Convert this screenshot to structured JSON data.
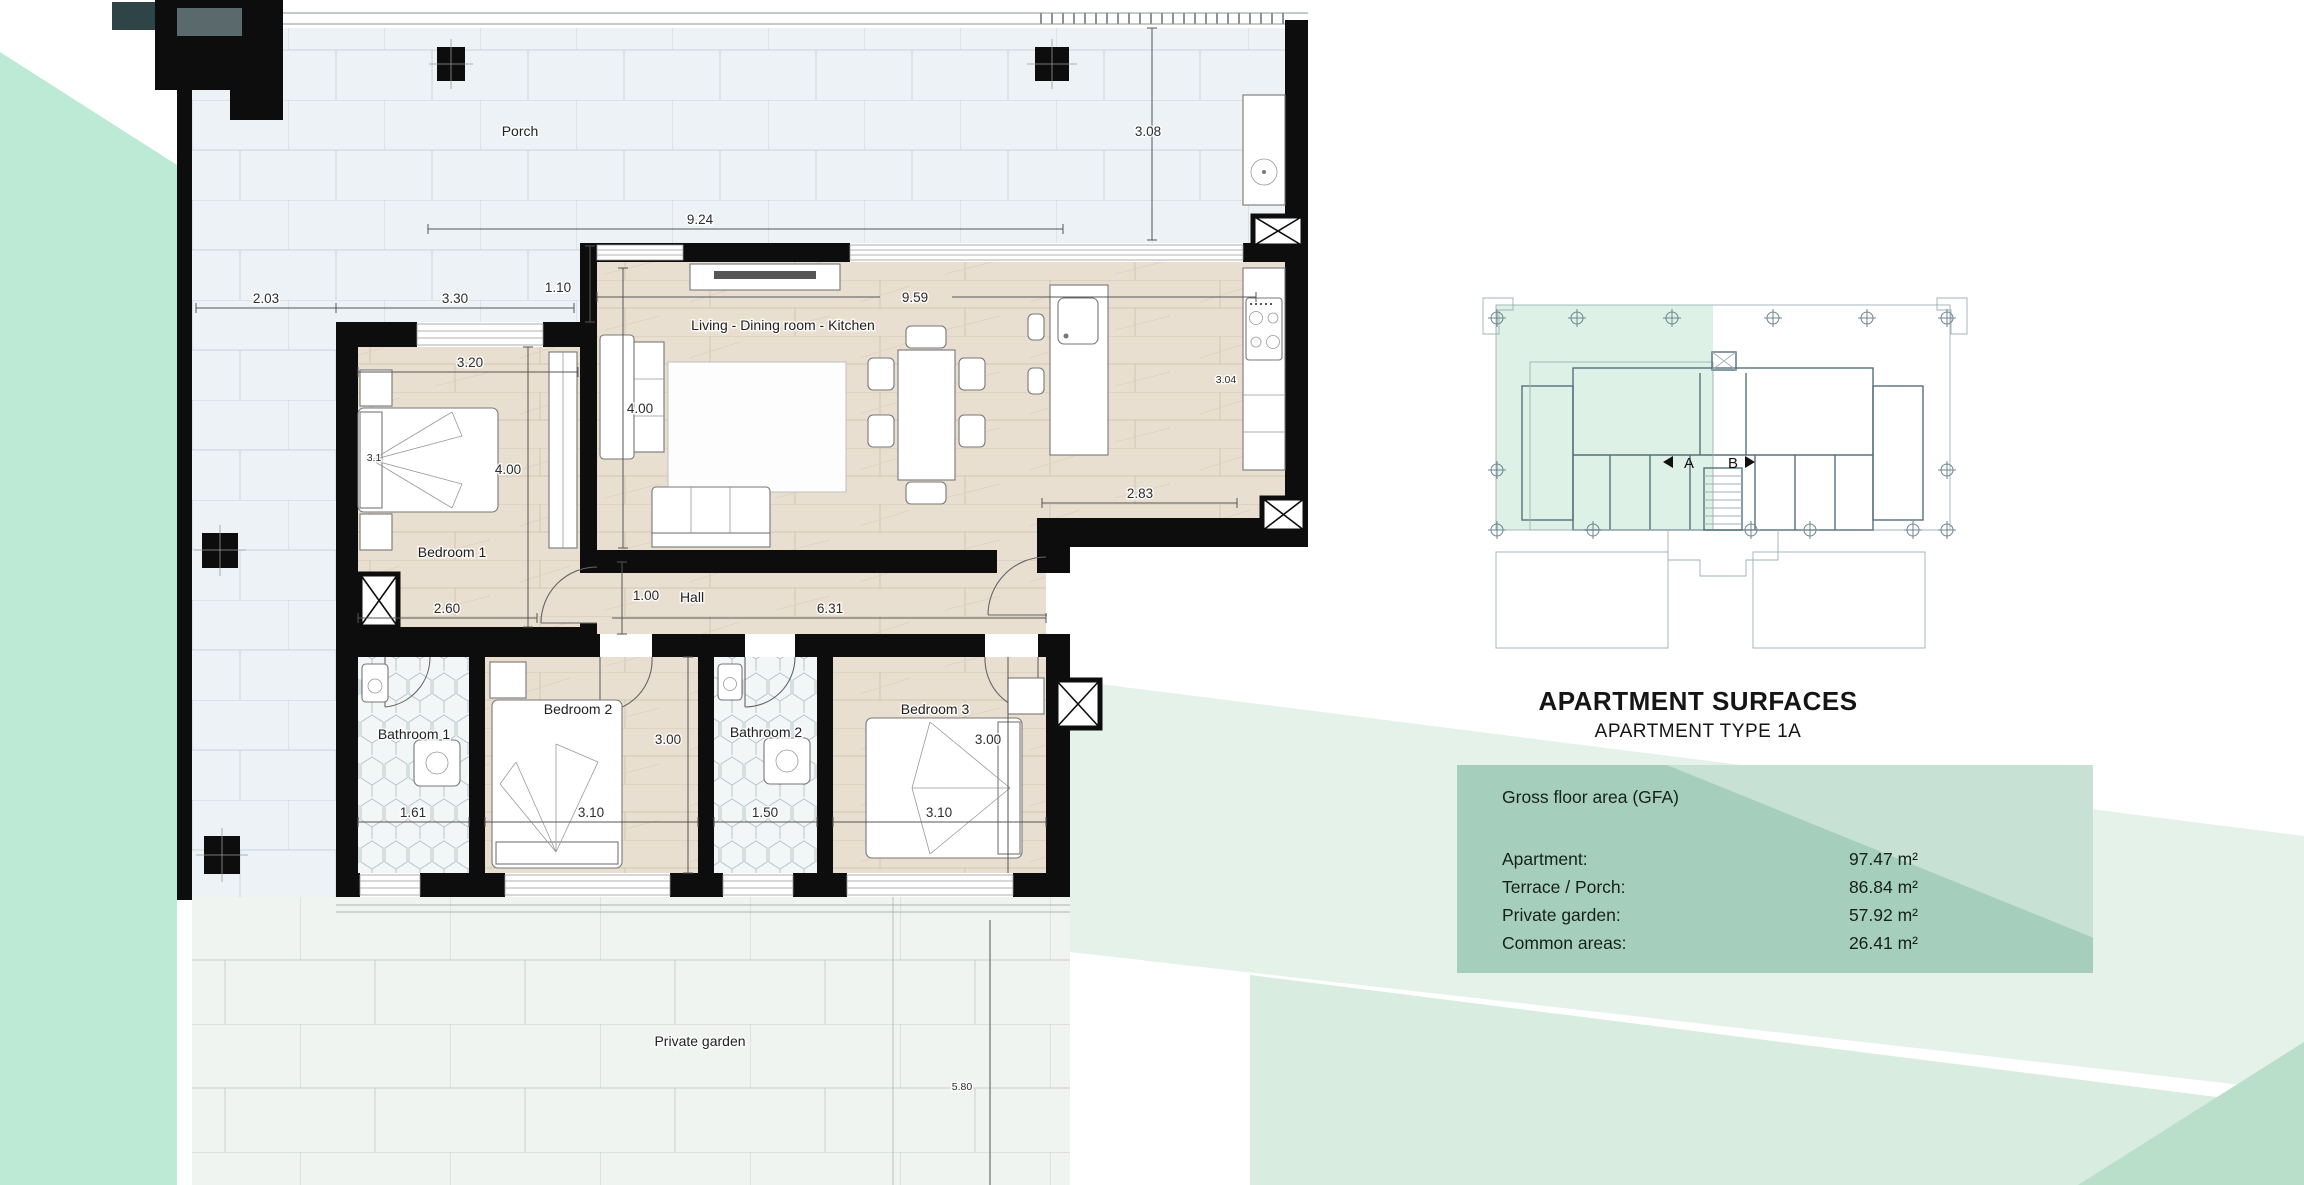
{
  "floor_plan": {
    "rooms": {
      "porch": "Porch",
      "living": "Living - Dining room - Kitchen",
      "bedroom1": "Bedroom 1",
      "hall": "Hall",
      "bathroom1": "Bathroom 1",
      "bedroom2": "Bedroom 2",
      "bathroom2": "Bathroom 2",
      "bedroom3": "Bedroom 3",
      "garden": "Private garden"
    },
    "dims": {
      "porch_width": "9.24",
      "porch_depth": "3.08",
      "terrace_width": "2.03",
      "bedroom1_outer": "3.30",
      "offset": "1.10",
      "living_width": "9.59",
      "living_height": "4.00",
      "bedroom1_width": "3.20",
      "bedroom1_height": "4.00",
      "bed_width": "3.1",
      "kitchen_side": "3.04",
      "entry_width": "2.83",
      "hall_left": "2.60",
      "hall_width": "1.00",
      "hall_length": "6.31",
      "row_height": "3.00",
      "bathroom1_width": "1.61",
      "bedroom2_width": "3.10",
      "bathroom2_width": "1.50",
      "bedroom3_width": "3.10",
      "bedroom3_height": "3.00",
      "garden_depth": "5.80"
    }
  },
  "key_plan": {
    "unit_a": "A",
    "unit_b": "B"
  },
  "surfaces": {
    "title": "APARTMENT SURFACES",
    "subtitle": "APARTMENT TYPE 1A",
    "section_label": "Gross floor area (GFA)",
    "rows": [
      {
        "label": "Apartment:",
        "value": "97.47 m²"
      },
      {
        "label": "Terrace / Porch:",
        "value": "86.84 m²"
      },
      {
        "label": "Private garden:",
        "value": "57.92 m²"
      },
      {
        "label": "Common areas:",
        "value": "26.41 m²"
      }
    ]
  }
}
